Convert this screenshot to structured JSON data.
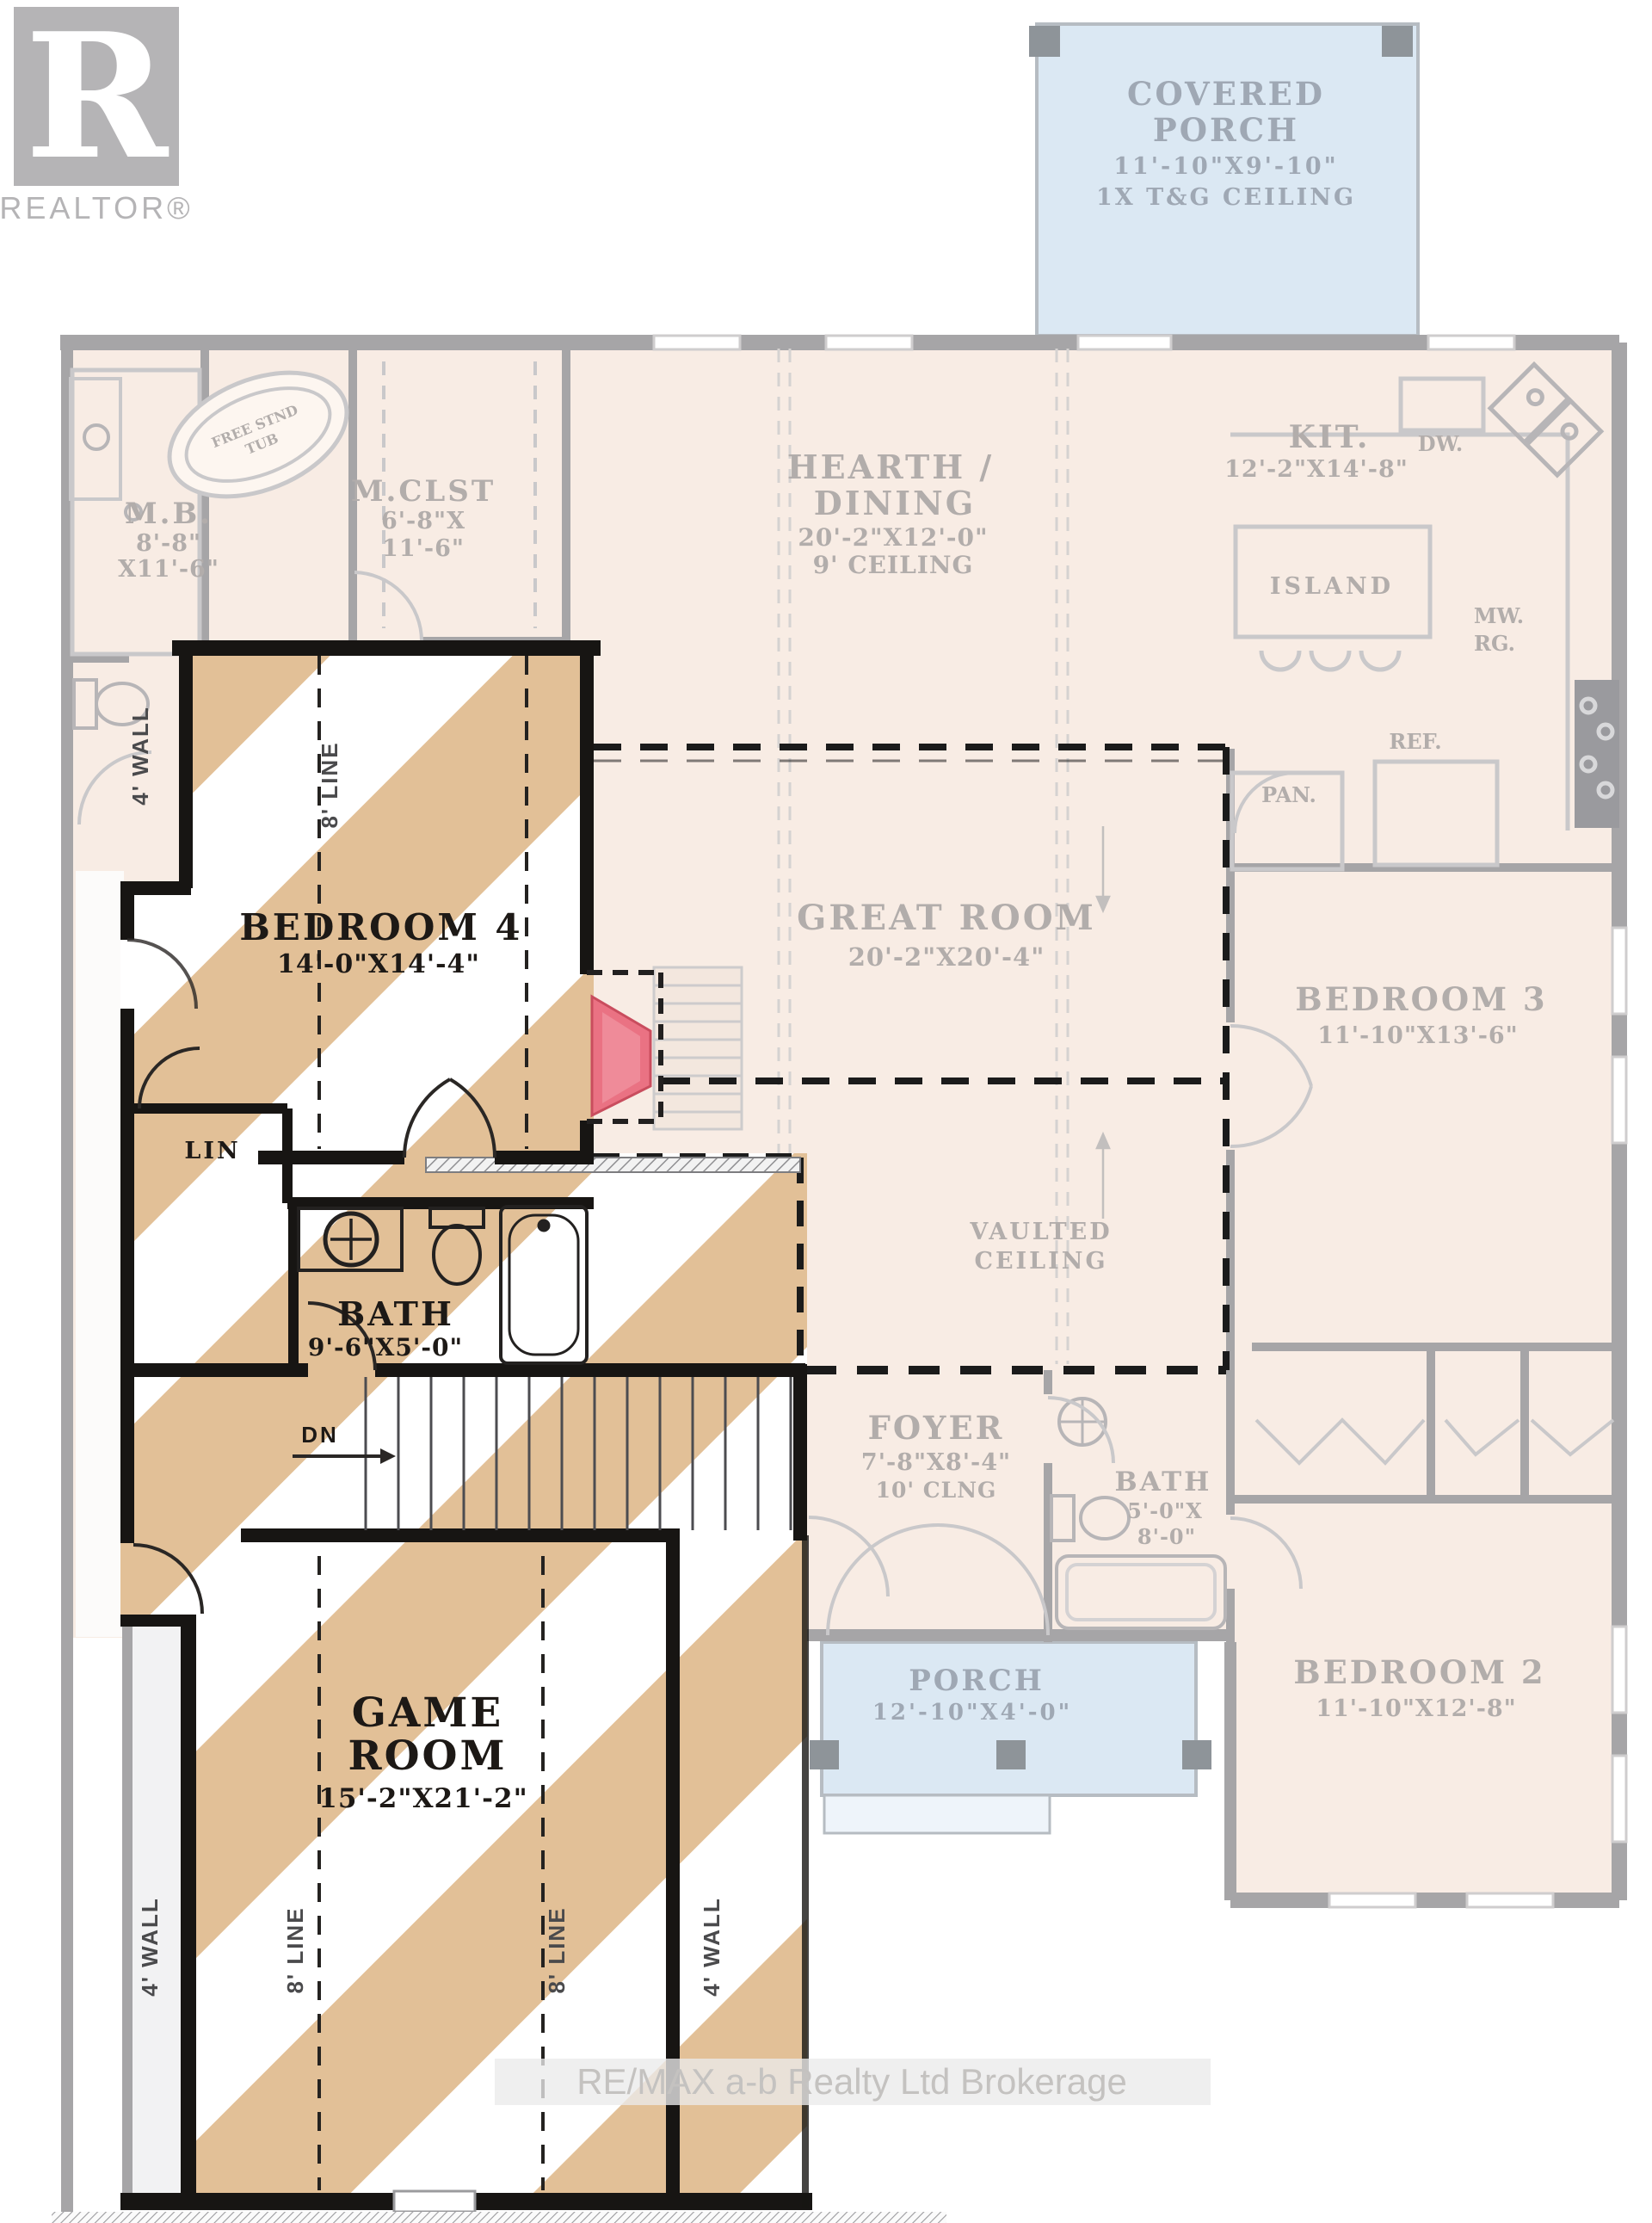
{
  "branding": {
    "logo_letter": "R",
    "logo_text": "REALTOR®",
    "watermark": "RE/MAX a-b Realty Ltd Brokerage"
  },
  "colors": {
    "faded_fill": "#f8ece4",
    "faded_wall": "#a6a5a7",
    "faded_text": "#b2adab",
    "porch_fill": "#dbe8f3",
    "stripe_tan": "#e2c097",
    "bold_wall": "#171513",
    "fireplace": "#ea7283"
  },
  "floor1": {
    "covered_porch": {
      "line1": "COVERED",
      "line2": "PORCH",
      "dims": "11'-10\"X9'-10\"",
      "note": "1X T&G CEILING"
    },
    "mb": {
      "name": "M.B.",
      "dims1": "8'-8\"",
      "dims2": "X11'-6\""
    },
    "mclst": {
      "name": "M.CLST",
      "dims1": "6'-8\"X",
      "dims2": "11'-6\""
    },
    "free_tub": {
      "line1": "FREE STND",
      "line2": "TUB"
    },
    "hearth": {
      "line1": "HEARTH /",
      "line2": "DINING",
      "dims": "20'-2\"X12'-0\"",
      "note": "9' CEILING"
    },
    "kitchen": {
      "name": "KIT.",
      "dims": "12'-2\"X14'-8\"",
      "island": "ISLAND",
      "dw": "DW.",
      "mw": "MW.",
      "rg": "RG.",
      "ref": "REF.",
      "pan": "PAN."
    },
    "great_room": {
      "name": "GREAT ROOM",
      "dims": "20'-2\"X20'-4\""
    },
    "vaulted": {
      "line1": "VAULTED",
      "line2": "CEILING"
    },
    "bedroom3": {
      "name": "BEDROOM 3",
      "dims": "11'-10\"X13'-6\""
    },
    "bedroom2": {
      "name": "BEDROOM 2",
      "dims": "11'-10\"X12'-8\""
    },
    "foyer": {
      "name": "FOYER",
      "dims": "7'-8\"X8'-4\"",
      "note": "10' CLNG"
    },
    "bath": {
      "name": "BATH",
      "dims1": "5'-0\"X",
      "dims2": "8'-0\""
    },
    "porch": {
      "name": "PORCH",
      "dims": "12'-10\"X4'-0\""
    }
  },
  "floor2": {
    "bedroom4": {
      "name": "BEDROOM 4",
      "dims": "14'-0\"X14'-4\""
    },
    "bath": {
      "name": "BATH",
      "dims": "9'-6\"X5'-0\""
    },
    "lin": "LIN",
    "dn": "DN",
    "game_room": {
      "line1": "GAME",
      "line2": "ROOM",
      "dims": "15'-2\"X21'-2\""
    },
    "wall_labels": {
      "w1": "4' WALL",
      "l1": "8' LINE",
      "l2": "8' LINE",
      "w2": "4' WALL",
      "w3": "4' WALL",
      "l3": "8' LINE"
    }
  }
}
